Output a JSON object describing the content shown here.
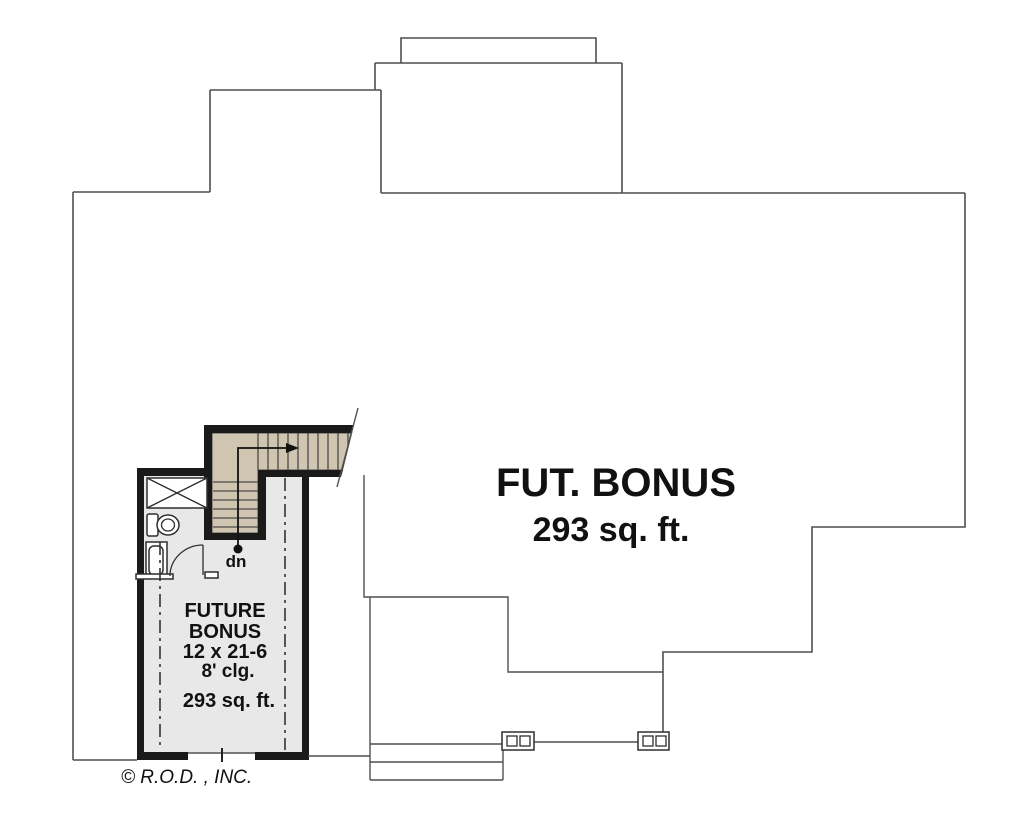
{
  "plan": {
    "main_label": {
      "line1": "FUT. BONUS",
      "line2": "293 sq. ft."
    },
    "room_label": {
      "line1": "FUTURE",
      "line2": "BONUS",
      "dimensions": "12 x 21-6",
      "ceiling": "8' clg.",
      "area": "293 sq. ft."
    },
    "stair_label": {
      "down": "dn"
    },
    "copyright": "© R.O.D. , INC."
  },
  "colors": {
    "wall": "#1a1a1a",
    "line": "#4f4f4f",
    "floor_fill": "#e8e8e8",
    "stair_fill": "#cfc5b1",
    "tread_line": "#4a4a4a",
    "fixture_line": "#2e2e2e",
    "text": "#111111"
  }
}
